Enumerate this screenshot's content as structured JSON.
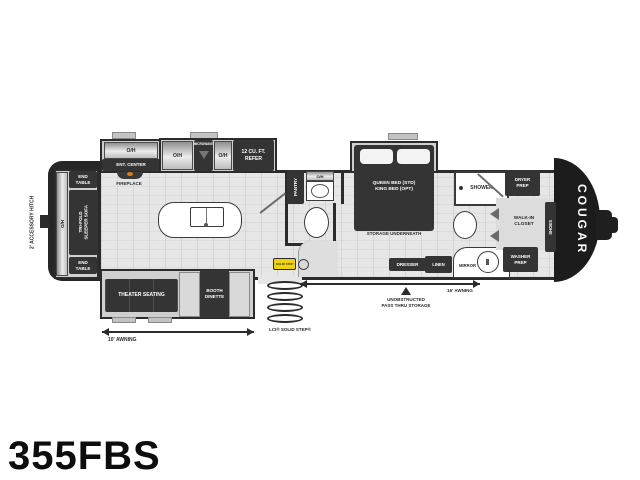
{
  "title": {
    "model": "355FBS"
  },
  "exterior": {
    "brand": "COUGAR",
    "accessory_hitch": "2' ACCESSORY HITCH",
    "awning_rear": "10' AWNING",
    "awning_front": "16' AWNING",
    "pass_thru": "UNOBSTRUCTED\nPASS THRU STORAGE",
    "step_label": "LCI® SOLID STEP®",
    "step_logo": "SOLID STEP"
  },
  "living": {
    "end_table_top": "END\nTABLE",
    "end_table_bottom": "END\nTABLE",
    "oh_rear": "O/H",
    "sofa": "TRI-FOLD\nSLEEPER SOFA",
    "oh_ent": "O/H",
    "ent_center": "ENT. CENTER",
    "fireplace": "FIREPLACE",
    "theater": "THEATER SEATING",
    "dinette": "BOOTH\nDINETTE"
  },
  "kitchen": {
    "oh_left": "O/H",
    "microwave": "MICROWAVE",
    "oh_right": "O/H",
    "refer": "12 CU. FT.\nREFER",
    "pantry": "PANTRY"
  },
  "bath_mid": {
    "oh": "O/H"
  },
  "bedroom": {
    "bed": "QUEEN BED (STD)\nKING BED (OPT)",
    "storage": "STORAGE UNDERNEATH",
    "dresser": "DRESSER"
  },
  "bath_front": {
    "shower": "SHOWER",
    "mirror": "MIRROR",
    "linen": "LINEN",
    "dryer": "DRYER\nPREP",
    "washer": "WASHER\nPREP",
    "closet": "WALK-IN\nCLOSET",
    "shoes": "SHOES"
  },
  "colors": {
    "wall": "#2b2b2b",
    "furniture": "#343434",
    "floor": "#e6e6e6",
    "slide_floor": "#cfcfcf",
    "flame_accent": "#e07b1f",
    "step_logo_yellow": "#f2d10e"
  }
}
